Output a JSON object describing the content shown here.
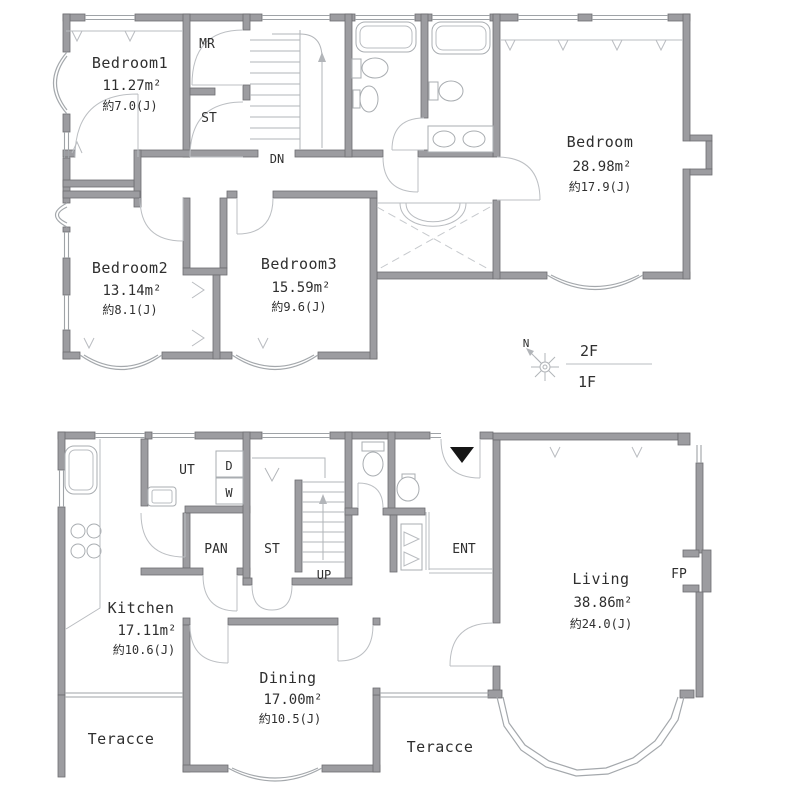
{
  "colors": {
    "wall": "#9c9ca0",
    "wall_edge": "#6d6d71",
    "thin_line": "#aeb2b6",
    "text": "#2f2f2f",
    "entrance_marker": "#161616",
    "background": "#ffffff"
  },
  "legend": {
    "floor_upper": "2F",
    "floor_lower": "1F",
    "compass_north": "N"
  },
  "floor2": {
    "bedroom1": {
      "name": "Bedroom1",
      "area": "11.27m²",
      "tatami": "約7.0(J)"
    },
    "master_bedroom": {
      "name": "Bedroom",
      "area": "28.98m²",
      "tatami": "約17.9(J)"
    },
    "bedroom2": {
      "name": "Bedroom2",
      "area": "13.14m²",
      "tatami": "約8.1(J)"
    },
    "bedroom3": {
      "name": "Bedroom3",
      "area": "15.59m²",
      "tatami": "約9.6(J)"
    },
    "mr": "MR",
    "st": "ST",
    "dn": "DN"
  },
  "floor1": {
    "kitchen": {
      "name": "Kitchen",
      "area": "17.11m²",
      "tatami": "約10.6(J)"
    },
    "dining": {
      "name": "Dining",
      "area": "17.00m²",
      "tatami": "約10.5(J)"
    },
    "living": {
      "name": "Living",
      "area": "38.86m²",
      "tatami": "約24.0(J)"
    },
    "ut": "UT",
    "dryer": "D",
    "washer": "W",
    "pan": "PAN",
    "st": "ST",
    "up": "UP",
    "ent": "ENT",
    "fp": "FP",
    "terrace_left": "Teracce",
    "terrace_right": "Teracce"
  }
}
